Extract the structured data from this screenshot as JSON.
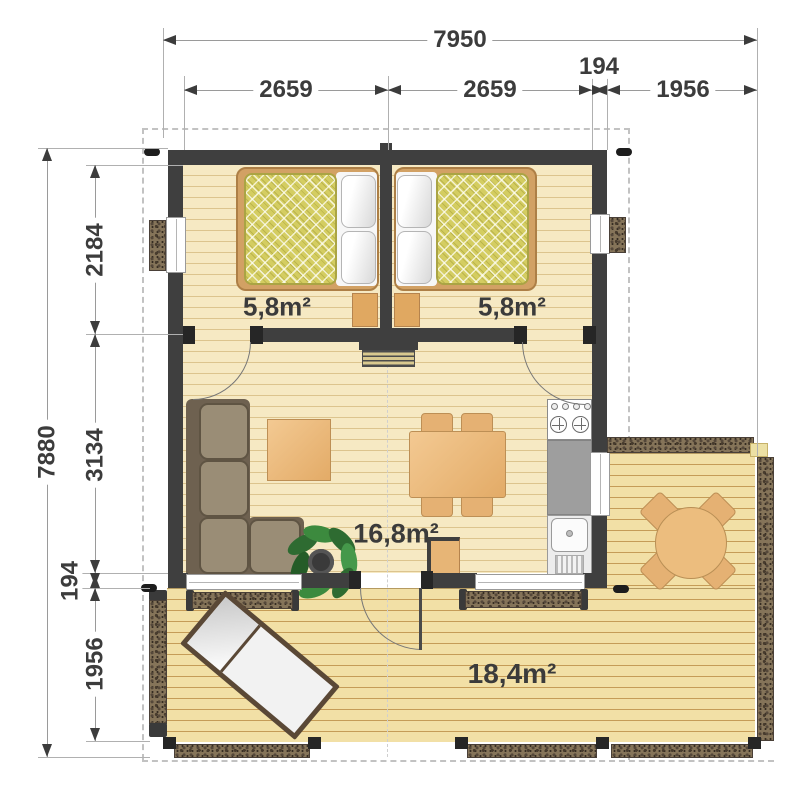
{
  "drawing": {
    "type": "floor-plan",
    "units": "mm"
  },
  "dimensions": {
    "top": {
      "total": "7950",
      "segments": [
        "2659",
        "2659",
        "194",
        "1956"
      ]
    },
    "left": {
      "total": "7880",
      "segments": [
        "2184",
        "3134",
        "194",
        "1956"
      ]
    }
  },
  "areas": {
    "bedroom_left": "5,8m²",
    "bedroom_right": "5,8m²",
    "living_room": "16,8m²",
    "terrace": "18,4m²"
  },
  "colors": {
    "wall": "#3f3f3f",
    "interior_floor": "#f6e9c3",
    "deck_floor": "#f2e0a6",
    "railing_hatch": "#857459",
    "mattress": "#d4cd61",
    "furniture_wood": "#e5b173",
    "sofa": "#9a8d76",
    "kitchen_counter": "#9e9e9e",
    "plant_green": "#3c8a3e",
    "dimension_text": "#3c3c3c"
  },
  "furniture": [
    "double-bed-left",
    "double-bed-right",
    "nightstand-left",
    "nightstand-right",
    "radiator",
    "corner-sofa",
    "coffee-table",
    "dining-table",
    "dining-chairs",
    "potted-plant",
    "cabinet",
    "stove",
    "kitchen-counter",
    "kitchen-sink",
    "sun-lounger",
    "round-terrace-table",
    "terrace-chairs"
  ]
}
